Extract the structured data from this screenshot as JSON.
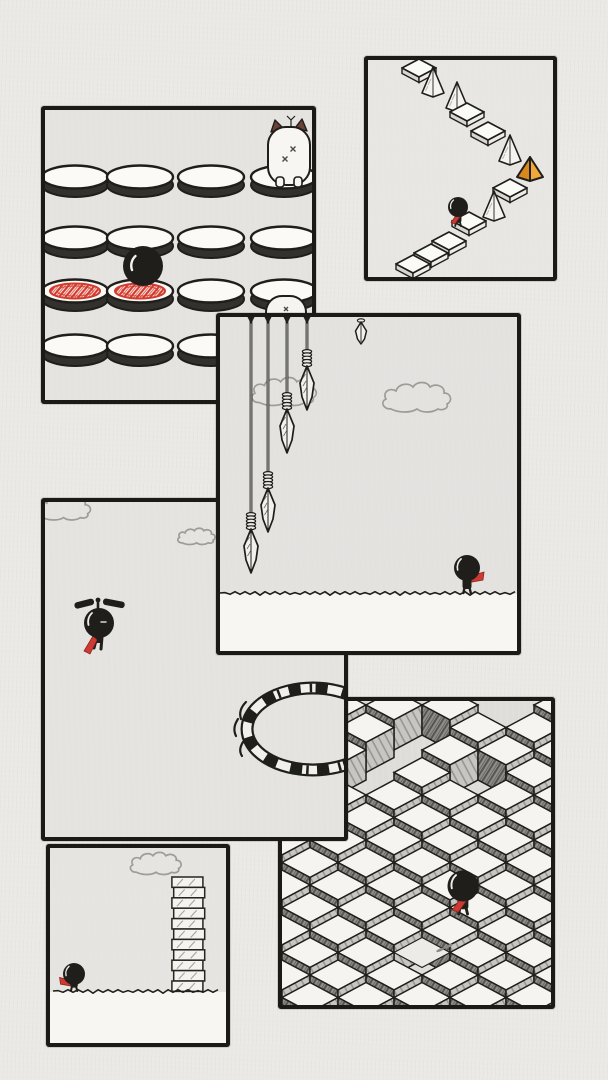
{
  "meta": {
    "title": "hand-drawn stickman platformer screenshots collage",
    "page_bg": "#eae9e6",
    "ink": "#1f1e1b",
    "border": "#1b1a17",
    "red": "#cd3a31",
    "red_dark": "#8e2420",
    "orange": "#f0a83a",
    "orange_dark": "#d8891e",
    "cloud_stroke": "#9d9c98",
    "ear_brown": "#6b4036",
    "rim_dark": "#32312e",
    "paper_white": "#f7f6f3"
  },
  "panels": [
    {
      "key": "cubes",
      "name": "panel-isometric-cubes",
      "x": 282,
      "y": 701,
      "w": 269,
      "h": 304,
      "z": 1,
      "bg": "#deddd9",
      "scene": {
        "type": "cubes",
        "cube": {
          "half_w": 28,
          "half_h": 15,
          "side_h": 30,
          "pitch_x": 56,
          "pitch_y": 45
        },
        "col_a_x0": 282,
        "col_b_x0": 310,
        "row_a_y0": 705,
        "row_b_y0": 727.5,
        "cols_a": 6,
        "cols_b": 5,
        "rows_a": 8,
        "rows_b": 7,
        "gaps": [
          [
            394,
            750
          ],
          [
            422,
            727.5
          ],
          [
            366,
            772.5
          ],
          [
            478,
            772.5
          ],
          [
            506,
            705
          ],
          [
            422,
            952.5
          ]
        ],
        "floor_tiles": [
          [
            422,
            952.5
          ]
        ],
        "footprints": [
          [
            440,
            950
          ],
          [
            449,
            946
          ]
        ],
        "stickman": {
          "cx": 463,
          "cy": 886,
          "r": 15.5,
          "scarf": "down-left",
          "feet": 914
        }
      }
    },
    {
      "key": "jump-pads",
      "name": "panel-jump-pads",
      "x": 45,
      "y": 110,
      "w": 267,
      "h": 290,
      "z": 2,
      "bg": "#e4e3e0",
      "scene": {
        "type": "jump_pads",
        "cols": [
          75,
          140,
          211,
          284
        ],
        "rows": [
          177,
          238,
          291,
          346
        ],
        "red_cells": [
          [
            0,
            2
          ],
          [
            1,
            2
          ]
        ],
        "ball": {
          "cx": 143,
          "cy": 266,
          "r": 20
        },
        "hamster": {
          "cx": 289,
          "bottom": 185
        },
        "peek_hamster": {
          "cx": 286,
          "top": 296
        }
      }
    },
    {
      "key": "zigzag",
      "name": "panel-zigzag-path",
      "x": 368,
      "y": 60,
      "w": 185,
      "h": 217,
      "z": 2,
      "bg": "#e7e6e3",
      "scene": {
        "type": "zigzag",
        "items": [
          {
            "t": "tile",
            "x": 419,
            "y": 68
          },
          {
            "t": "spike",
            "x": 433,
            "y": 87
          },
          {
            "t": "spike",
            "x": 457,
            "y": 102
          },
          {
            "t": "tile",
            "x": 467,
            "y": 112
          },
          {
            "t": "tile",
            "x": 488,
            "y": 131
          },
          {
            "t": "spike",
            "x": 510,
            "y": 155
          },
          {
            "t": "goal",
            "x": 530,
            "y": 170
          },
          {
            "t": "tile",
            "x": 510,
            "y": 188
          },
          {
            "t": "spike",
            "x": 494,
            "y": 211
          },
          {
            "t": "tile",
            "x": 469,
            "y": 221
          },
          {
            "t": "stickman",
            "x": 458,
            "y": 207
          },
          {
            "t": "tile",
            "x": 449,
            "y": 241
          },
          {
            "t": "tile",
            "x": 431,
            "y": 253
          },
          {
            "t": "tile",
            "x": 413,
            "y": 264
          }
        ]
      }
    },
    {
      "key": "helicopter",
      "name": "panel-helicopter-flyer",
      "x": 45,
      "y": 502,
      "w": 299,
      "h": 335,
      "z": 3,
      "bg": "#e4e3e0",
      "scene": {
        "type": "helicopter",
        "clouds": [
          [
            70,
            512,
            0.8
          ],
          [
            201,
            539,
            0.55
          ]
        ],
        "flyer": {
          "cx": 99,
          "cy": 623,
          "r": 15
        },
        "ring": {
          "cx": 313,
          "cy": 729,
          "rx": 66,
          "ry": 41
        }
      }
    },
    {
      "key": "tower",
      "name": "panel-block-tower",
      "x": 50,
      "y": 848,
      "w": 176,
      "h": 195,
      "z": 3,
      "bg": "#e5e4e1",
      "scene": {
        "type": "tower",
        "cloud": [
          162,
          867,
          0.75
        ],
        "tower": {
          "cx": 188,
          "top": 877,
          "w": 31,
          "block_h": 10.4,
          "blocks": 11
        },
        "ground_y": 991,
        "stickman": {
          "cx": 74,
          "cy": 974,
          "r": 11,
          "scarf": "left",
          "feet": 991
        }
      }
    },
    {
      "key": "spears",
      "name": "panel-falling-spears",
      "x": 220,
      "y": 317,
      "w": 297,
      "h": 334,
      "z": 4,
      "bg": "#e3e2df",
      "scene": {
        "type": "spears",
        "spears": [
          {
            "x": 251,
            "tip": 573
          },
          {
            "x": 268,
            "tip": 532
          },
          {
            "x": 287,
            "tip": 453
          },
          {
            "x": 307,
            "tip": 410
          }
        ],
        "falling_head": {
          "x": 361,
          "top": 320,
          "tip": 344
        },
        "clouds": [
          [
            292,
            396,
            0.95
          ],
          [
            425,
            402,
            1.0
          ]
        ],
        "ground_y": 593,
        "stickman": {
          "cx": 467,
          "cy": 568,
          "r": 13,
          "scarf": "right",
          "feet": 593
        }
      }
    }
  ]
}
